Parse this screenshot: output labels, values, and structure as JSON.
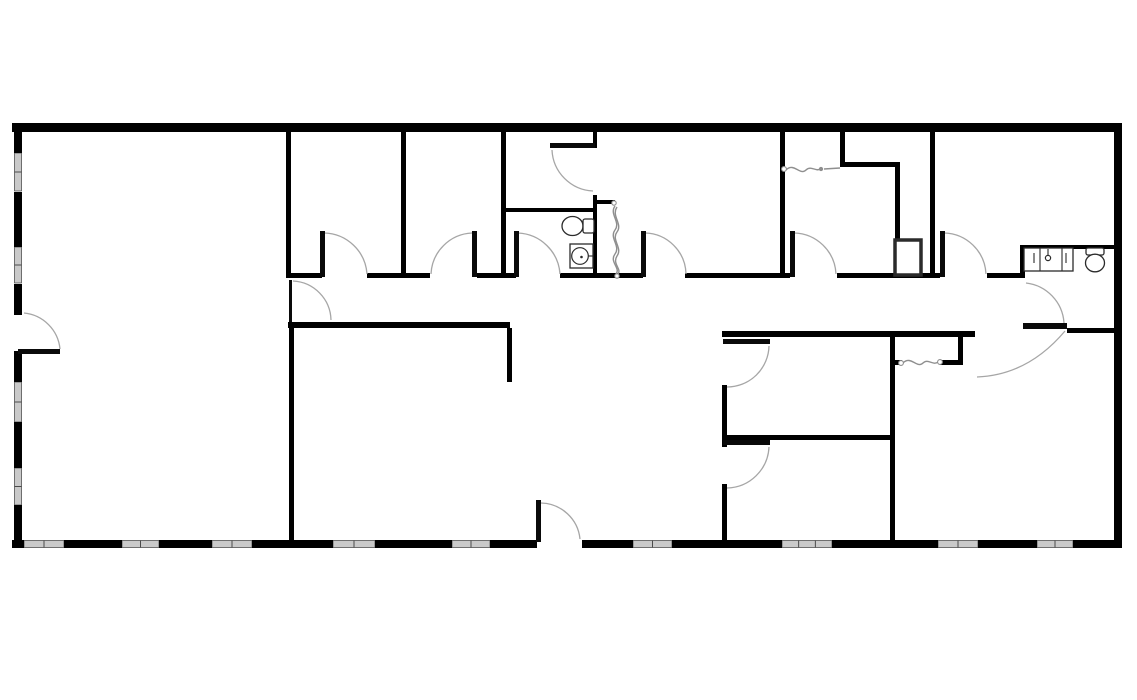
{
  "canvas": {
    "width": 1137,
    "height": 700,
    "background": "#ffffff"
  },
  "colors": {
    "wall": "#000000",
    "door_arc": "#a6a6a6",
    "door_leaf": "#0a0a0a",
    "accordion": "#8f8f8f",
    "window_fill": "#c9c9c9",
    "window_edge": "#3c3c3c",
    "fixture_stroke": "#2b2b2b",
    "background": "#ffffff"
  },
  "floor_plan": {
    "exterior_walls": [
      {
        "n": "outer-wall-top",
        "r": [
          12,
          123,
          1110,
          9
        ]
      },
      {
        "n": "outer-wall-right",
        "r": [
          1114,
          123,
          8,
          425
        ]
      },
      {
        "n": "outer-wall-left-seg1",
        "r": [
          14,
          123,
          8,
          30
        ]
      },
      {
        "n": "outer-wall-left-seg2",
        "r": [
          14,
          192,
          8,
          55
        ]
      },
      {
        "n": "outer-wall-left-seg3",
        "r": [
          14,
          284,
          8,
          31
        ]
      },
      {
        "n": "outer-wall-left-seg4",
        "r": [
          14,
          351,
          8,
          31
        ]
      },
      {
        "n": "outer-wall-left-seg5",
        "r": [
          14,
          422,
          8,
          46
        ]
      },
      {
        "n": "outer-wall-left-seg6",
        "r": [
          14,
          505,
          8,
          43
        ]
      },
      {
        "n": "outer-wall-bottom-seg1",
        "r": [
          12,
          540,
          12,
          8
        ]
      },
      {
        "n": "outer-wall-bottom-seg2",
        "r": [
          64,
          540,
          58,
          8
        ]
      },
      {
        "n": "outer-wall-bottom-seg3",
        "r": [
          159,
          540,
          53,
          8
        ]
      },
      {
        "n": "outer-wall-bottom-seg4",
        "r": [
          252,
          540,
          81,
          8
        ]
      },
      {
        "n": "outer-wall-bottom-seg5",
        "r": [
          375,
          540,
          77,
          8
        ]
      },
      {
        "n": "outer-wall-bottom-seg6",
        "r": [
          490,
          540,
          47,
          8
        ]
      },
      {
        "n": "outer-wall-bottom-seg7",
        "r": [
          582,
          540,
          51,
          8
        ]
      },
      {
        "n": "outer-wall-bottom-seg8",
        "r": [
          672,
          540,
          110,
          8
        ]
      },
      {
        "n": "outer-wall-bottom-seg9",
        "r": [
          832,
          540,
          106,
          8
        ]
      },
      {
        "n": "outer-wall-bottom-seg10",
        "r": [
          978,
          540,
          59,
          8
        ]
      },
      {
        "n": "outer-wall-bottom-seg11",
        "r": [
          1073,
          540,
          49,
          8
        ]
      }
    ],
    "windows": [
      {
        "n": "window-left-1",
        "r": [
          14.5,
          153,
          7,
          38
        ]
      },
      {
        "n": "window-left-2",
        "r": [
          14.5,
          247,
          7,
          36
        ]
      },
      {
        "n": "window-left-3",
        "r": [
          14.5,
          382,
          7,
          40
        ]
      },
      {
        "n": "window-left-4",
        "r": [
          14.5,
          468,
          7,
          37
        ]
      },
      {
        "n": "window-bottom-1",
        "r": [
          24,
          540.5,
          40,
          7
        ]
      },
      {
        "n": "window-bottom-2",
        "r": [
          122,
          540.5,
          37,
          7
        ]
      },
      {
        "n": "window-bottom-3",
        "r": [
          212,
          540.5,
          40,
          7
        ]
      },
      {
        "n": "window-bottom-4",
        "r": [
          333,
          540.5,
          42,
          7
        ]
      },
      {
        "n": "window-bottom-5",
        "r": [
          452,
          540.5,
          38,
          7
        ]
      },
      {
        "n": "window-bottom-6",
        "r": [
          633,
          540.5,
          39,
          7
        ]
      },
      {
        "n": "window-bottom-7",
        "r": [
          782,
          540.5,
          50,
          7
        ]
      },
      {
        "n": "window-bottom-8",
        "r": [
          938,
          540.5,
          40,
          7
        ]
      },
      {
        "n": "window-bottom-9",
        "r": [
          1037,
          540.5,
          36,
          7
        ]
      }
    ],
    "interior_walls": [
      {
        "n": "wall-room-a-b-divider",
        "r": [
          286,
          132,
          5,
          146
        ]
      },
      {
        "n": "wall-room-b-c-divider",
        "r": [
          401,
          132,
          5,
          146
        ]
      },
      {
        "n": "wall-room-c-bath-divider",
        "r": [
          501,
          132,
          5,
          146
        ]
      },
      {
        "n": "wall-vestibule-bath-divider",
        "r": [
          501,
          208,
          95,
          4
        ]
      },
      {
        "n": "wall-room-d-west-upper",
        "r": [
          593,
          132,
          4,
          16
        ]
      },
      {
        "n": "wall-room-d-west-lower",
        "r": [
          593,
          195,
          4,
          83
        ]
      },
      {
        "n": "wall-closet-stub",
        "r": [
          595,
          200,
          20,
          4
        ]
      },
      {
        "n": "wall-room-d-e-divider",
        "r": [
          780,
          132,
          5,
          146
        ]
      },
      {
        "n": "wall-closet-e-west",
        "r": [
          840,
          132,
          5,
          34
        ]
      },
      {
        "n": "wall-closet-e-south",
        "r": [
          840,
          162,
          60,
          5
        ]
      },
      {
        "n": "wall-closet-e-east",
        "r": [
          895,
          162,
          5,
          80
        ]
      },
      {
        "n": "wall-room-e-f-divider",
        "r": [
          930,
          132,
          5,
          146
        ]
      },
      {
        "n": "wall-alcove-counter-top",
        "r": [
          1020,
          245,
          94,
          4
        ]
      },
      {
        "n": "wall-alcove-west-jamb",
        "r": [
          1020,
          245,
          5,
          33
        ]
      },
      {
        "n": "wall-corridor-top-seg1",
        "r": [
          291,
          273,
          31,
          5
        ]
      },
      {
        "n": "wall-corridor-top-seg2",
        "r": [
          367,
          273,
          63,
          5
        ]
      },
      {
        "n": "wall-corridor-top-seg3",
        "r": [
          477,
          273,
          39,
          5
        ]
      },
      {
        "n": "wall-corridor-top-seg4",
        "r": [
          560,
          273,
          83,
          5
        ]
      },
      {
        "n": "wall-corridor-top-seg5",
        "r": [
          685,
          273,
          105,
          5
        ]
      },
      {
        "n": "wall-corridor-top-seg6",
        "r": [
          837,
          273,
          103,
          5
        ]
      },
      {
        "n": "wall-corridor-top-seg7",
        "r": [
          987,
          273,
          35,
          5
        ]
      },
      {
        "n": "wall-corridor-bottom-west",
        "r": [
          288,
          322,
          222,
          6
        ]
      },
      {
        "n": "wall-corridor-bottom-east",
        "r": [
          722,
          331,
          253,
          6
        ]
      },
      {
        "n": "wall-east-end-south",
        "r": [
          1067,
          328,
          47,
          5
        ]
      },
      {
        "n": "wall-open-area-stub",
        "r": [
          507,
          328,
          5,
          54
        ]
      },
      {
        "n": "wall-bottom-left-divider",
        "r": [
          289,
          322,
          5,
          226
        ]
      },
      {
        "n": "wall-room-g-west",
        "r": [
          722,
          385,
          5,
          62
        ]
      },
      {
        "n": "wall-room-h-west",
        "r": [
          722,
          484,
          5,
          58
        ]
      },
      {
        "n": "wall-room-g-h-divider",
        "r": [
          722,
          435,
          170,
          5
        ]
      },
      {
        "n": "wall-room-i-west",
        "r": [
          890,
          337,
          5,
          205
        ]
      },
      {
        "n": "wall-closet-i-stub-west",
        "r": [
          892,
          360,
          10,
          5
        ]
      },
      {
        "n": "wall-closet-i-stub-east",
        "r": [
          940,
          360,
          20,
          5
        ]
      },
      {
        "n": "wall-closet-i-east",
        "r": [
          958,
          331,
          5,
          34
        ]
      }
    ],
    "door_leaves": [
      {
        "n": "door-leaf-room-a-exterior",
        "r": [
          18,
          349,
          42,
          5
        ]
      },
      {
        "n": "door-leaf-corridor-west",
        "r": [
          289,
          280,
          3,
          42
        ]
      },
      {
        "n": "door-leaf-room-b",
        "r": [
          320,
          231,
          5,
          46
        ]
      },
      {
        "n": "door-leaf-room-c",
        "r": [
          472,
          231,
          5,
          46
        ]
      },
      {
        "n": "door-leaf-bathroom",
        "r": [
          514,
          231,
          5,
          46
        ]
      },
      {
        "n": "door-leaf-vestibule",
        "r": [
          550,
          143,
          45,
          5
        ]
      },
      {
        "n": "door-leaf-room-d",
        "r": [
          641,
          231,
          5,
          46
        ]
      },
      {
        "n": "door-leaf-room-e",
        "r": [
          790,
          231,
          5,
          46
        ]
      },
      {
        "n": "door-leaf-room-f",
        "r": [
          940,
          231,
          5,
          46
        ]
      },
      {
        "n": "door-leaf-room-g",
        "r": [
          723,
          339,
          47,
          5
        ]
      },
      {
        "n": "door-leaf-room-h",
        "r": [
          723,
          440,
          47,
          5
        ]
      },
      {
        "n": "door-leaf-entry",
        "r": [
          536,
          500,
          5,
          42
        ]
      },
      {
        "n": "door-leaf-east-end",
        "r": [
          1023,
          323,
          44,
          6
        ]
      }
    ],
    "door_arcs": [
      {
        "n": "door-arc-room-a-exterior",
        "d": "M 24 313 A 40 40 0 0 1 60 349"
      },
      {
        "n": "door-arc-corridor-west",
        "d": "M 293 281 A 40 40 0 0 1 331 320"
      },
      {
        "n": "door-arc-room-b",
        "d": "M 324 233 A 44 44 0 0 1 367 274"
      },
      {
        "n": "door-arc-room-c",
        "d": "M 431 274 A 43 43 0 0 1 472 233"
      },
      {
        "n": "door-arc-bathroom",
        "d": "M 518 233 A 44 44 0 0 1 560 274"
      },
      {
        "n": "door-arc-vestibule",
        "d": "M 552 150 A 43 43 0 0 0 593 191"
      },
      {
        "n": "door-arc-room-d",
        "d": "M 645 233 A 42 42 0 0 1 686 274"
      },
      {
        "n": "door-arc-room-e",
        "d": "M 794 233 A 43 43 0 0 1 836 274"
      },
      {
        "n": "door-arc-room-f",
        "d": "M 944 233 A 43 43 0 0 1 986 274"
      },
      {
        "n": "door-arc-alcove",
        "d": "M 1026 283 A 43 43 0 0 1 1064 323"
      },
      {
        "n": "door-arc-east-end-swing",
        "d": "M 1065 331 Q 1028 375 977 377"
      },
      {
        "n": "door-arc-room-g",
        "d": "M 769 346 A 42 42 0 0 1 727 387"
      },
      {
        "n": "door-arc-room-h",
        "d": "M 769 447 A 43 43 0 0 1 727 488"
      },
      {
        "n": "door-arc-entry",
        "d": "M 541 503 A 40 40 0 0 1 580 539"
      }
    ],
    "accordion_doors": [
      {
        "n": "accordion-door-closet-bath",
        "paths": [
          "M 615 206 C 609 214 621 222 615 230 C 609 238 621 246 615 254 C 609 262 621 268 616 274",
          "M 617 207 C 611 216 623 224 617 232 C 611 240 623 248 617 256 C 612 264 622 269 618 274"
        ],
        "dots": [
          {
            "c": [
              614,
              203,
              2.2
            ],
            "f": false
          },
          {
            "c": [
              617,
              276,
              2.2
            ],
            "f": false
          }
        ]
      },
      {
        "n": "accordion-door-closet-e",
        "paths": [
          "M 786 170 C 794 162 800 176 806 170 C 811 165 816 172 820 169",
          "M 824 169 L 840 168"
        ],
        "dots": [
          {
            "c": [
              784,
              169,
              2.4
            ],
            "f": false
          },
          {
            "c": [
              821,
              169,
              1.6
            ],
            "f": true
          }
        ]
      },
      {
        "n": "accordion-door-closet-i",
        "paths": [
          "M 903 363 C 911 355 917 369 923 363 C 928 358 933 366 938 362"
        ],
        "dots": [
          {
            "c": [
              901,
              363,
              2.4
            ],
            "f": false
          },
          {
            "c": [
              940,
              362,
              2.4
            ],
            "f": false
          }
        ]
      }
    ],
    "fixtures": [
      {
        "n": "column-box",
        "shapes": [
          {
            "t": "rect",
            "r": [
              895,
              240,
              26,
              35
            ],
            "sw": 3.5
          }
        ]
      },
      {
        "n": "toilet-bathroom",
        "shapes": [
          {
            "t": "ellipse",
            "e": [
              572.5,
              226,
              10.5,
              9.5
            ]
          },
          {
            "t": "rect",
            "r": [
              583,
              219,
              11,
              14
            ],
            "rx": 2
          }
        ]
      },
      {
        "n": "sink-bathroom",
        "shapes": [
          {
            "t": "rect",
            "r": [
              570,
              244,
              23,
              24
            ]
          },
          {
            "t": "circle",
            "c": [
              580,
              256,
              8.3
            ]
          },
          {
            "t": "dot",
            "c": [
              581.5,
              257,
              1.3
            ]
          },
          {
            "t": "line",
            "l": [
              588,
              256,
              592.5,
              256
            ]
          }
        ]
      },
      {
        "n": "sink-counter-alcove",
        "shapes": [
          {
            "t": "rect",
            "r": [
              1024,
              248,
              49,
              23
            ]
          },
          {
            "t": "line",
            "l": [
              1040,
              248.5,
              1040,
              270.5
            ]
          },
          {
            "t": "line",
            "l": [
              1062,
              248.5,
              1062,
              270.5
            ]
          },
          {
            "t": "line",
            "l": [
              1034,
              253,
              1034,
              263
            ]
          },
          {
            "t": "line",
            "l": [
              1066,
              253,
              1066,
              263
            ]
          },
          {
            "t": "line",
            "l": [
              1048,
              249,
              1048,
              255
            ]
          },
          {
            "t": "circle",
            "c": [
              1048,
              258,
              2.6
            ]
          }
        ]
      },
      {
        "n": "toilet-alcove",
        "shapes": [
          {
            "t": "rect",
            "r": [
              1086,
              248,
              18,
              7
            ],
            "rx": 2
          },
          {
            "t": "ellipse",
            "e": [
              1095,
              263,
              9.5,
              8.8
            ]
          }
        ]
      }
    ]
  }
}
